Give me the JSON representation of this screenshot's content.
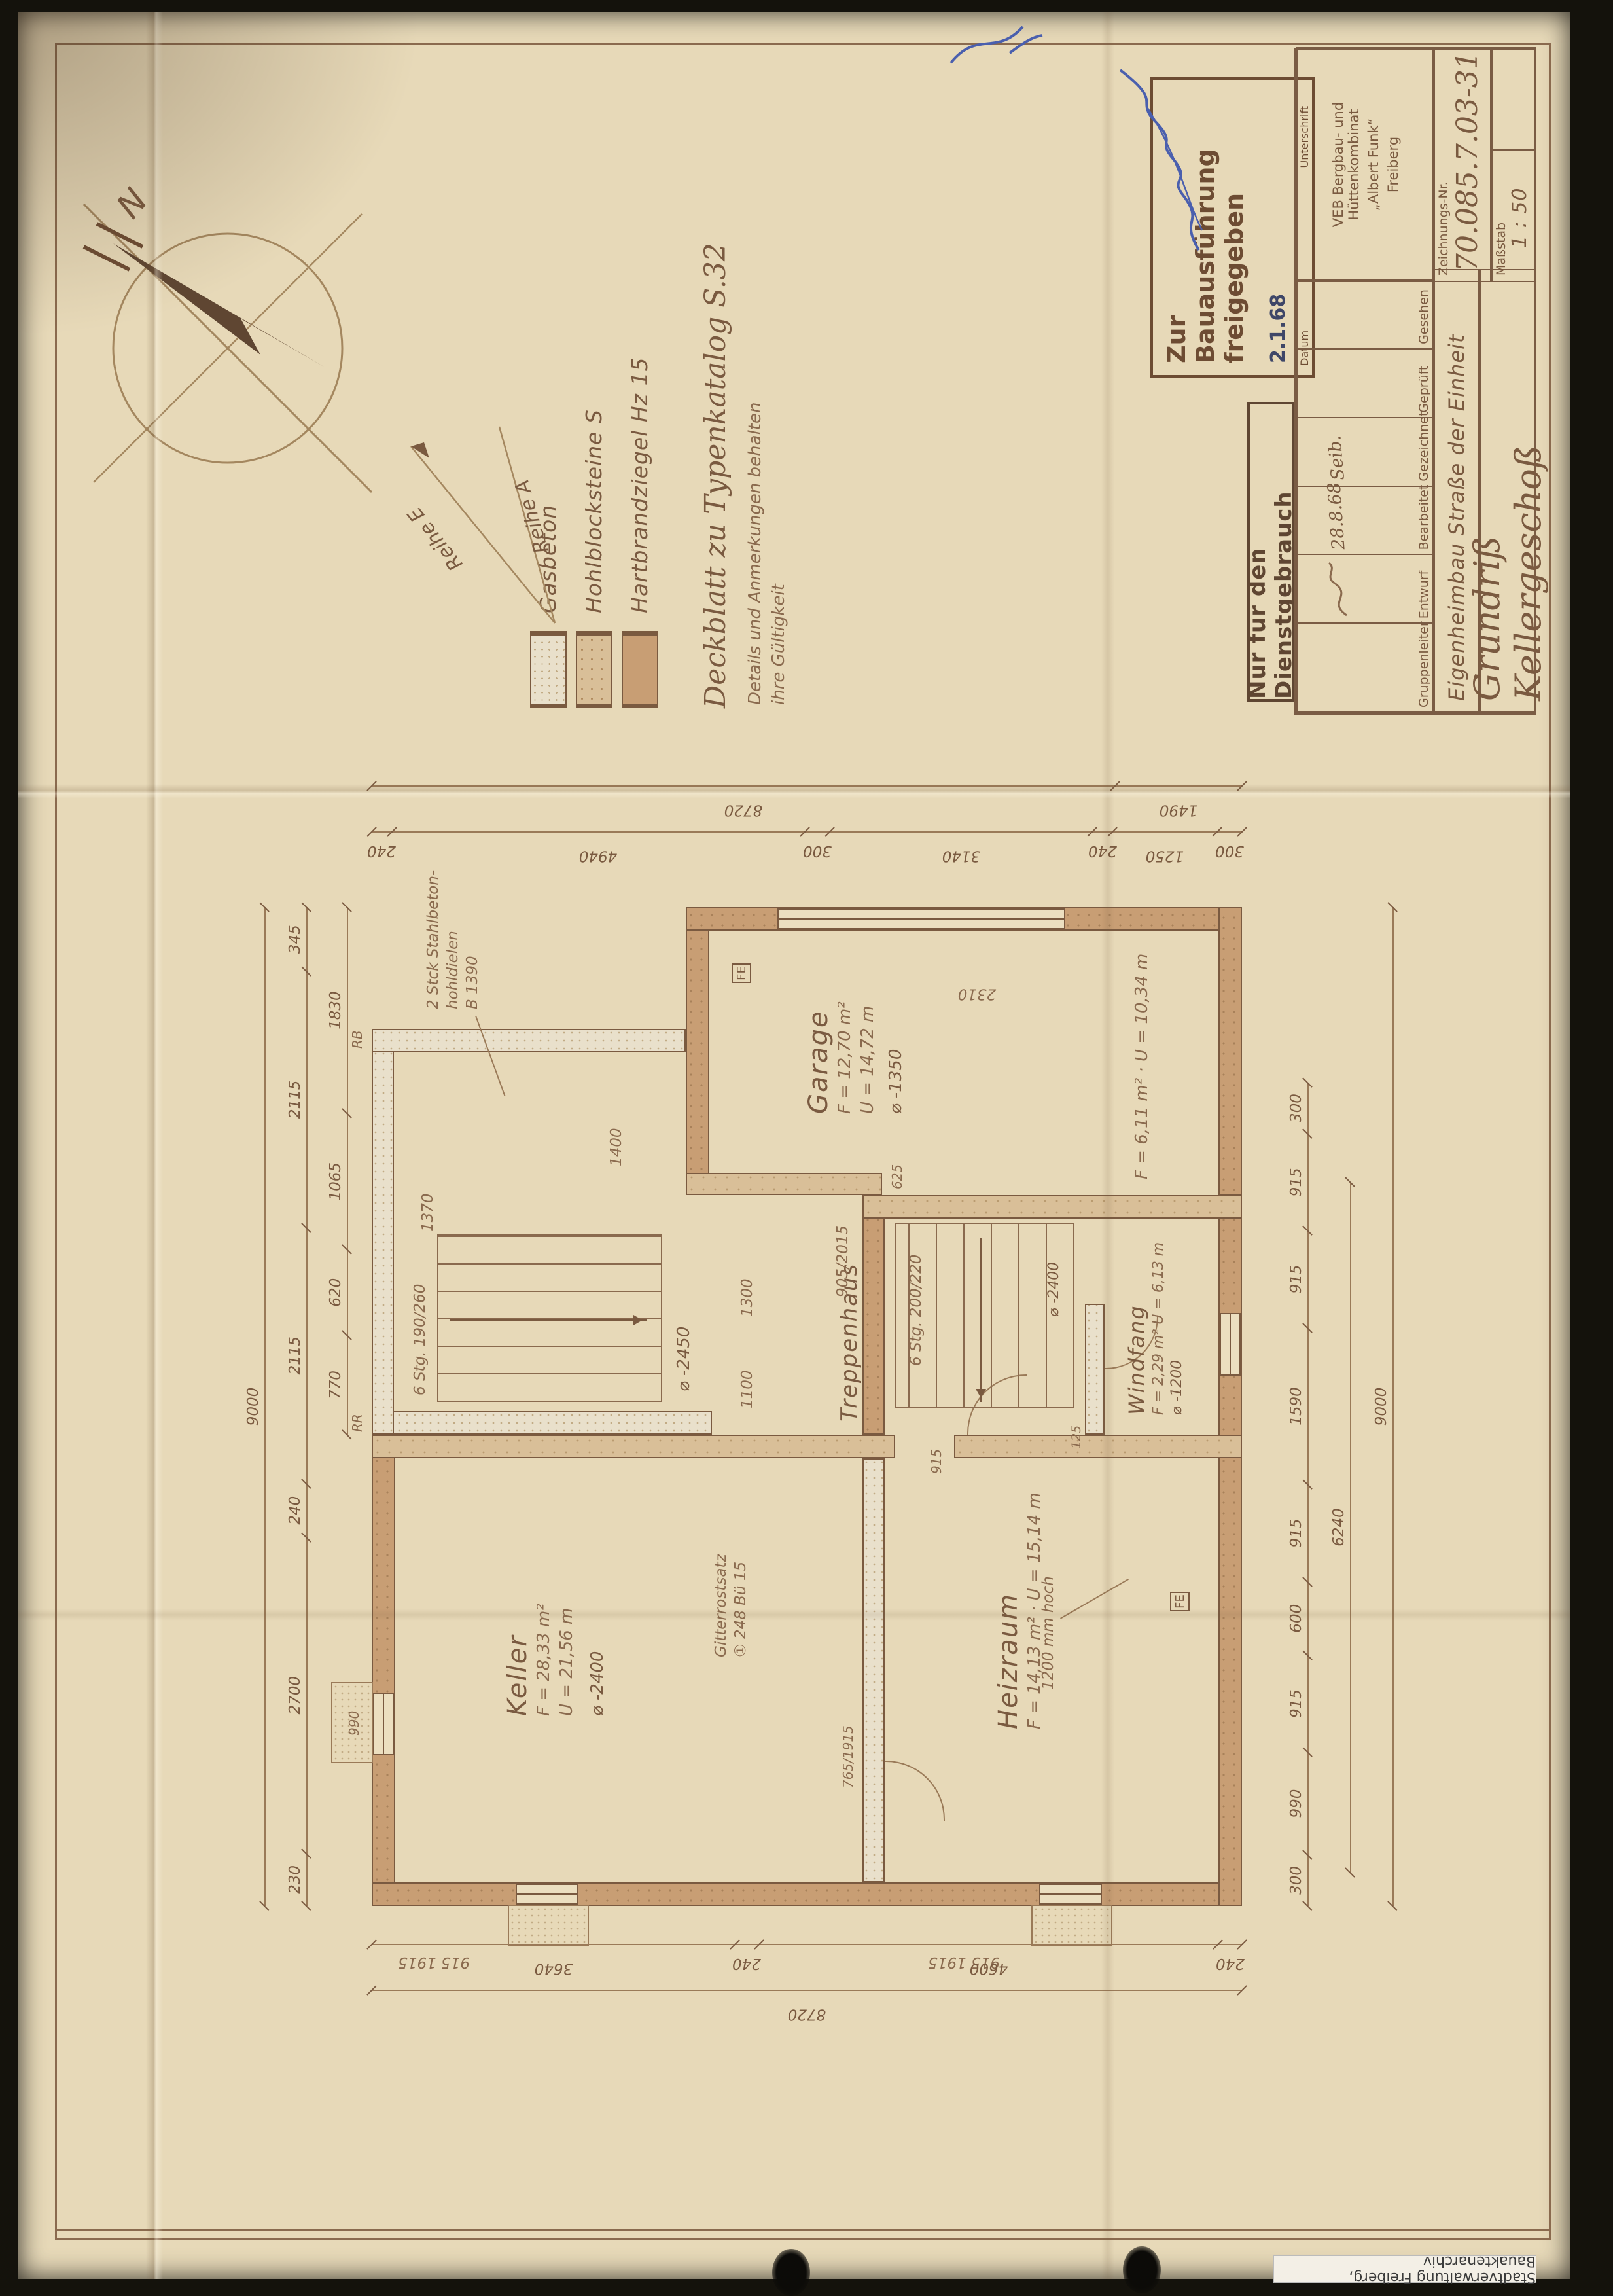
{
  "sheet": {
    "classification": "Nur für den Dienstgebrauch",
    "company1": "VEB Bergbau- und Hüttenkombinat",
    "company2": "„Albert Funk“",
    "company3": "Freiberg",
    "drawing_no_label": "Zeichnungs-Nr.",
    "drawing_no": "70.085.7.03-31",
    "scale_label": "Maßstab",
    "scale": "1 : 50",
    "project": "Eigenheimbau  Straße der Einheit",
    "title": "Grundriß  Kellergeschoß",
    "archive_label": "Stadtverwaltung Freiberg, Bauaktenarchiv"
  },
  "approval_stamp": {
    "line1": "Zur",
    "line2": "Bauausführung",
    "line3": "freigegeben",
    "date": "2.1.68",
    "date_label": "Datum",
    "sig_label": "Unterschrift"
  },
  "signature_table": {
    "roles": [
      "Gruppenleiter",
      "Entwurf",
      "Bearbeitet",
      "Gezeichnet",
      "Geprüft",
      "Gesehen"
    ],
    "entries": [
      "",
      "",
      "28.8.68",
      "Seib.",
      "",
      ""
    ]
  },
  "legend": {
    "items": [
      {
        "label": "Gasbeton"
      },
      {
        "label": "Hohlblocksteine S"
      },
      {
        "label": "Hartbrandziegel Hz 15"
      }
    ],
    "note_title": "Deckblatt zu Typenkatalog  S.32",
    "note_line1": "Details und Anmerkungen behalten",
    "note_line2": "ihre Gültigkeit"
  },
  "compass": {
    "north": "N",
    "row_a": "Reihe A",
    "row_e": "Reihe E"
  },
  "plan": {
    "rooms": {
      "keller": {
        "name": "Keller",
        "line1": "F = 28,33 m²",
        "line2": "U = 21,56 m",
        "level": "⌀ -2400"
      },
      "heizraum": {
        "name": "Heizraum",
        "line1": "F = 14,13 m²",
        "line2": "U = 15,14 m"
      },
      "treppenhaus": {
        "name": "Treppenhaus",
        "line1": "F = 6,11 m²",
        "line2": "U = 10,34 m",
        "level": "⌀ -2400"
      },
      "windfang": {
        "name": "Windfang",
        "line1": "F = 2,29 m²",
        "line2": "U = 6,13 m",
        "level": "⌀ -1200"
      },
      "garage": {
        "name": "Garage",
        "line1": "F = 12,70 m²",
        "line2": "U = 14,72 m",
        "level": "⌀ -1350"
      }
    },
    "notes": {
      "hohldielen1": "2 Stck Stahlbeton-",
      "hohldielen2": "hohldielen",
      "hohldielen3": "B 1390",
      "stair_ext": "6 Stg. 190/260",
      "stair_ext_level": "⌀ -2450",
      "stair_int": "6 Stg. 200/220",
      "wall_height": "1200 mm hoch",
      "grate1": "Gitterrostsatz",
      "grate2": "① 248 Bü 15",
      "fe": "FE",
      "rr": "RR",
      "rb": "RB",
      "d1370": "1370",
      "d1400": "1400",
      "d1100": "1100",
      "d1300": "1300",
      "d990": "990",
      "d2310": "2310",
      "d915": "915",
      "d625": "625",
      "d125": "125"
    },
    "door_marks": [
      {
        "w": "905",
        "h": "2015"
      },
      {
        "w": "915",
        "h": "1915"
      },
      {
        "w": "915",
        "h": "1915"
      },
      {
        "w": "765",
        "h": "1915"
      }
    ],
    "dims": {
      "bottom1": [
        "300",
        "990",
        "915",
        "600",
        "915",
        "1590",
        "915",
        "915",
        "300"
      ],
      "bottom2": [
        "6240"
      ],
      "bottom3": [
        "9000"
      ],
      "left1": [
        "3640",
        "240",
        "4600",
        "240"
      ],
      "left2": [
        "8720"
      ],
      "top1": [
        "230",
        "2700",
        "240",
        "2115",
        "2115",
        "345"
      ],
      "top2": [
        "9000"
      ],
      "top_inner": [
        "770",
        "620",
        "1065",
        "1830"
      ],
      "right1": [
        "240",
        "4940",
        "300",
        "3140",
        "240",
        "1250",
        "300"
      ],
      "right_total": "8720",
      "right_sub": "1490"
    }
  }
}
